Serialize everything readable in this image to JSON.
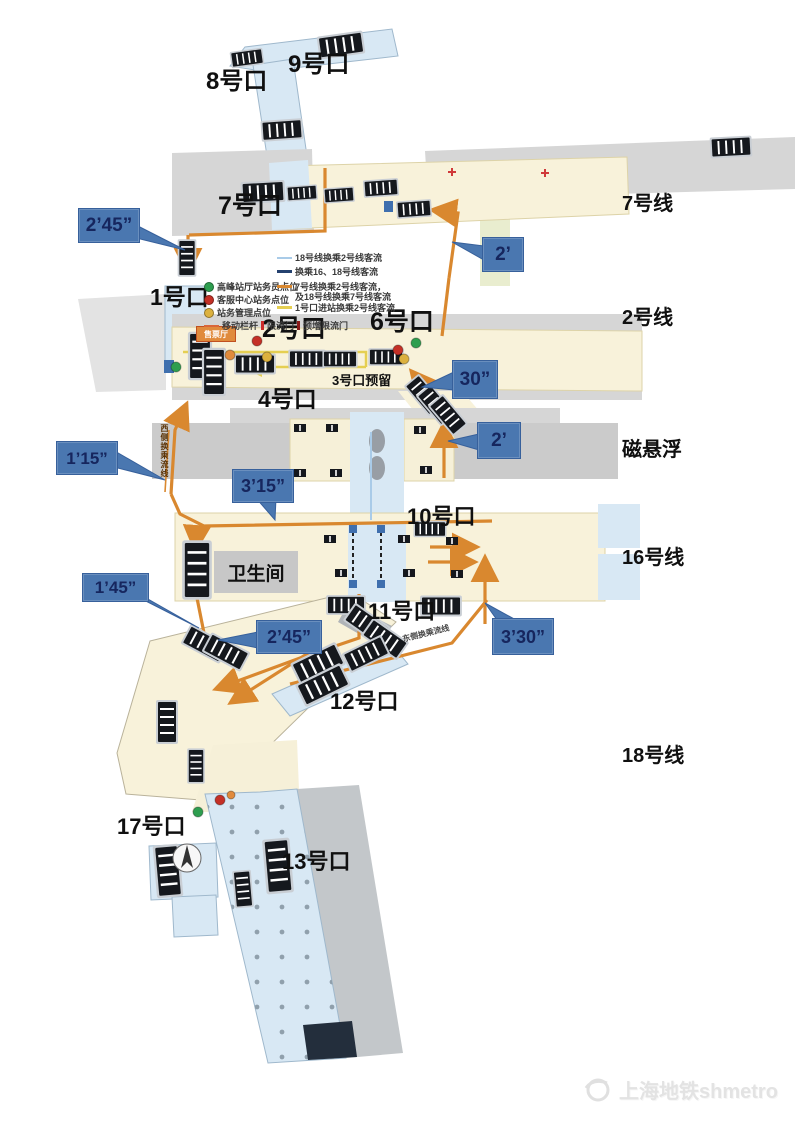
{
  "station": {
    "exits": {
      "e1": "1号口",
      "e2": "2号口",
      "e3": "3号口预留",
      "e4": "4号口",
      "e6": "6号口",
      "e7": "7号口",
      "e8": "8号口",
      "e9": "9号口",
      "e10": "10号口",
      "e11": "11号口",
      "e12": "12号口",
      "e13": "13号口",
      "e17": "17号口"
    },
    "lines": {
      "l7": "7号线",
      "l2": "2号线",
      "maglev": "磁悬浮",
      "l16": "16号线",
      "l18": "18号线"
    },
    "rooms": {
      "toilet": "卫生间",
      "ticket": "售票厅"
    },
    "callouts": {
      "c1": "2’45”",
      "c2": "2’",
      "c3": "30”",
      "c4": "2’",
      "c5": "1’15”",
      "c6": "3’15”",
      "c7": "1’45”",
      "c8": "2’45”",
      "c9": "3’30”"
    },
    "flow_labels": {
      "west": "西侧换乘流线",
      "east": "东侧换乘流线"
    },
    "legend": {
      "points": [
        {
          "color": "#2e9e4f",
          "label": "高峰站厅站务员点位"
        },
        {
          "color": "#c43026",
          "label": "客服中心站务点位"
        },
        {
          "color": "#dcb13e",
          "label": "站务管理点位"
        }
      ],
      "barrier": "移动栏杆",
      "gate1": "限流门",
      "gate2": "预增限流门",
      "flow1": "18号线换乘2号线客流",
      "flow2": "换乘16、18号线客流",
      "flow3a": "7号线换乘2号线客流，",
      "flow3b": "及18号线换乘7号线客流",
      "flow4": "1号口进站换乘2号线客流"
    },
    "watermark": "上海地铁shmetro",
    "colors": {
      "route_orange": "#d9882f",
      "callout_blue": "#4a77b0",
      "corridor_blue": "#d8e8f4",
      "concourse_cream": "#f8f2da",
      "entry_flow_yellow": "#e5cf52",
      "transfer_flow_blue": "#a9cbe8"
    }
  }
}
